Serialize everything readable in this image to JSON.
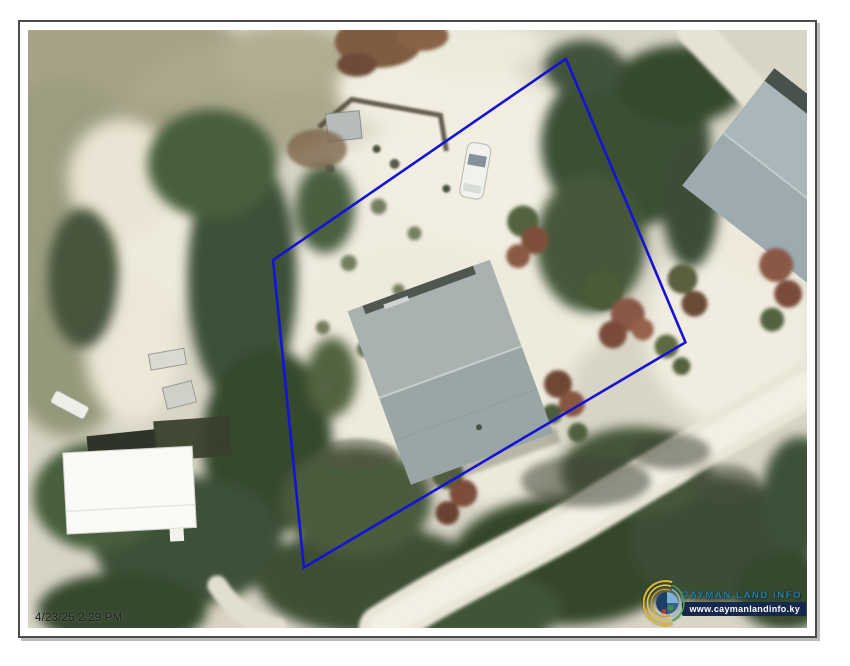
{
  "map": {
    "timestamp": "4/23/25 2:29 PM",
    "parcel": {
      "points": "540,29 660,315 277,542 246,232",
      "stroke_color": "#1512d6"
    }
  },
  "logo": {
    "name": "CAYMAN LAND INFO",
    "url": "www.caymanlandinfo.ky",
    "emblem": "globe-swirl-icon"
  },
  "theme": {
    "parcel-stroke": "#1512d6",
    "brand-text": "#2e7d9e",
    "url-bg": "#16284e",
    "frame-border": "#4c4c4c"
  }
}
